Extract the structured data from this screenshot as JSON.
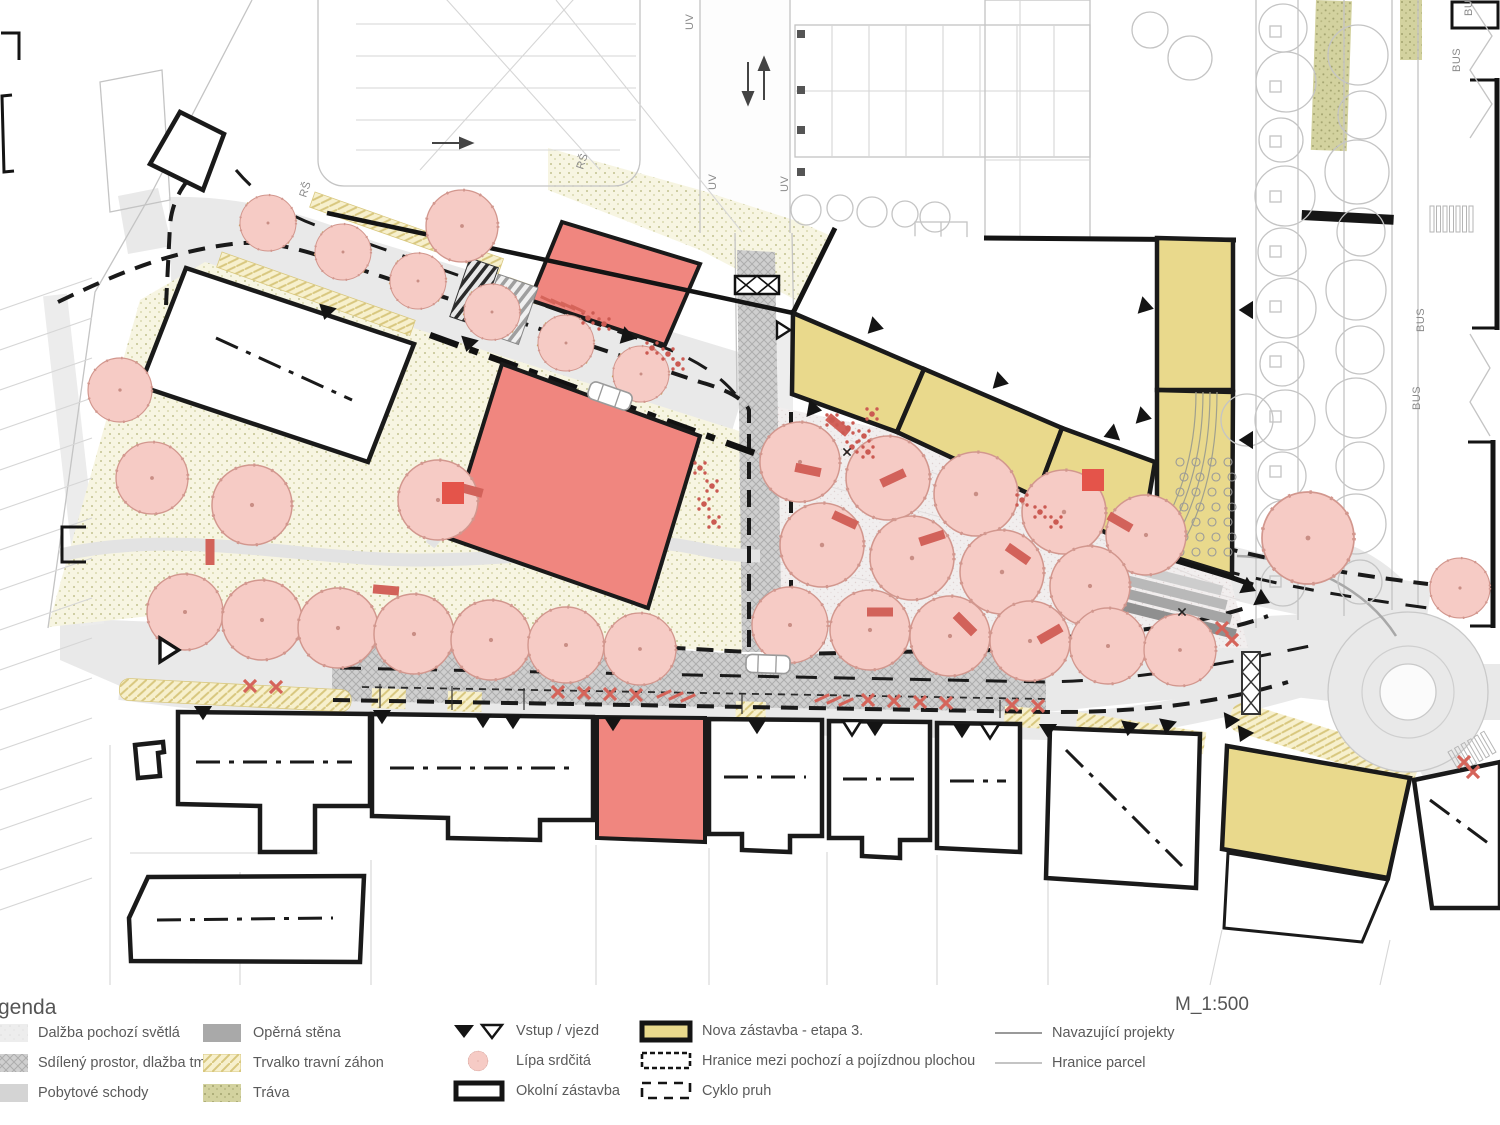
{
  "legend": {
    "title_fragment": "genda",
    "cols": [
      [
        {
          "label": "Dalžba pochozí světlá"
        },
        {
          "label": "Sdílený prostor, dlažba tmavá"
        },
        {
          "label": "Pobytové schody"
        }
      ],
      [
        {
          "label": "Opěrná stěna"
        },
        {
          "label": "Trvalko travní záhon"
        },
        {
          "label": "Tráva"
        }
      ],
      [
        {
          "label": "Vstup / vjezd"
        },
        {
          "label": "Lípa srdčitá"
        },
        {
          "label": "Okolní zástavba"
        }
      ],
      [
        {
          "label": "Nova zástavba - etapa 3."
        },
        {
          "label": "Hranice mezi pochozí a pojízdnou plochou"
        },
        {
          "label": "Cyklo pruh"
        }
      ],
      [
        {
          "label": "Navazující projekty"
        },
        {
          "label": "Hranice parcel"
        }
      ]
    ]
  },
  "scale": "M_1:500",
  "map_labels": {
    "bus": "BUS",
    "uv": "UV",
    "rs": "RŠ"
  },
  "colors": {
    "tree_fill": "#f6cbc5",
    "tree_stroke": "#d2978e",
    "building_red": "#f0867f",
    "building_yellow": "#e9d98c",
    "bench_red": "#d2625a",
    "table_red": "#cb5a52",
    "outline": "#1a1a1a",
    "context": "#c4c4c4",
    "paving_dark": "#cfcfcf",
    "paving_light": "#ececec",
    "park_bg": "#f7f5e2",
    "grass": "#d3d29f",
    "hatch_yellow": "#f7f0cd",
    "text_gray": "#5a5a5a"
  },
  "plan": {
    "trees": [
      [
        152,
        478,
        36
      ],
      [
        252,
        505,
        40
      ],
      [
        438,
        500,
        40
      ],
      [
        120,
        390,
        32
      ],
      [
        185,
        612,
        38
      ],
      [
        262,
        620,
        40
      ],
      [
        338,
        628,
        40
      ],
      [
        414,
        634,
        40
      ],
      [
        491,
        640,
        40
      ],
      [
        566,
        645,
        38
      ],
      [
        640,
        649,
        36
      ],
      [
        800,
        462,
        40
      ],
      [
        888,
        478,
        42
      ],
      [
        976,
        494,
        42
      ],
      [
        1064,
        512,
        42
      ],
      [
        1146,
        535,
        40
      ],
      [
        822,
        545,
        42
      ],
      [
        912,
        558,
        42
      ],
      [
        1002,
        572,
        42
      ],
      [
        1090,
        586,
        40
      ],
      [
        790,
        625,
        38
      ],
      [
        870,
        630,
        40
      ],
      [
        950,
        636,
        40
      ],
      [
        1030,
        641,
        40
      ],
      [
        1108,
        646,
        38
      ],
      [
        1180,
        650,
        36
      ],
      [
        462,
        226,
        36
      ],
      [
        1308,
        538,
        46
      ],
      [
        1460,
        588,
        30
      ],
      [
        268,
        223,
        28
      ],
      [
        343,
        252,
        28
      ],
      [
        418,
        281,
        28
      ],
      [
        492,
        312,
        28
      ],
      [
        566,
        343,
        28
      ],
      [
        641,
        374,
        28
      ]
    ],
    "planters": [
      [
        268,
        223
      ],
      [
        343,
        252
      ],
      [
        418,
        281
      ],
      [
        492,
        312
      ],
      [
        566,
        343
      ],
      [
        641,
        374
      ]
    ],
    "context_trees": [
      [
        1283,
        28,
        24
      ],
      [
        1286,
        82,
        30
      ],
      [
        1281,
        140,
        22
      ],
      [
        1285,
        196,
        30
      ],
      [
        1282,
        252,
        24
      ],
      [
        1286,
        308,
        30
      ],
      [
        1282,
        364,
        22
      ],
      [
        1285,
        420,
        30
      ],
      [
        1282,
        476,
        24
      ],
      [
        1286,
        530,
        30
      ],
      [
        1283,
        584,
        22
      ],
      [
        1358,
        55,
        30
      ],
      [
        1362,
        115,
        24
      ],
      [
        1357,
        172,
        32
      ],
      [
        1361,
        232,
        24
      ],
      [
        1356,
        290,
        30
      ],
      [
        1360,
        350,
        24
      ],
      [
        1356,
        408,
        30
      ],
      [
        1360,
        466,
        24
      ],
      [
        1356,
        524,
        30
      ],
      [
        1360,
        582,
        22
      ],
      [
        1247,
        420,
        26
      ],
      [
        1150,
        30,
        18
      ],
      [
        1190,
        58,
        22
      ],
      [
        806,
        210,
        15
      ],
      [
        840,
        208,
        13
      ],
      [
        872,
        212,
        15
      ],
      [
        905,
        214,
        13
      ],
      [
        935,
        217,
        15
      ]
    ],
    "context_squares": {
      "x": 1270,
      "y0": 26,
      "n": 11,
      "dy": 55,
      "s": 11
    },
    "benches": [
      [
        210,
        552,
        90
      ],
      [
        386,
        590,
        5
      ],
      [
        470,
        490,
        15
      ],
      [
        845,
        520,
        25
      ],
      [
        932,
        538,
        -18
      ],
      [
        1018,
        554,
        35
      ],
      [
        880,
        612,
        0
      ],
      [
        965,
        624,
        45
      ],
      [
        1050,
        634,
        -30
      ],
      [
        808,
        470,
        12
      ],
      [
        893,
        478,
        -25
      ],
      [
        838,
        425,
        40
      ],
      [
        1120,
        522,
        30
      ]
    ],
    "red_squares": [
      [
        453,
        493
      ],
      [
        1093,
        480
      ]
    ],
    "tables": [
      [
        588,
        318
      ],
      [
        604,
        324
      ],
      [
        652,
        348
      ],
      [
        668,
        354
      ],
      [
        678,
        364
      ],
      [
        700,
        468
      ],
      [
        712,
        486
      ],
      [
        704,
        504
      ],
      [
        714,
        522
      ],
      [
        832,
        420
      ],
      [
        848,
        428
      ],
      [
        864,
        436
      ],
      [
        872,
        414
      ],
      [
        1022,
        500
      ],
      [
        1040,
        512
      ],
      [
        1056,
        522
      ],
      [
        852,
        447
      ],
      [
        868,
        452
      ]
    ],
    "red_x": [
      [
        558,
        692
      ],
      [
        584,
        693
      ],
      [
        610,
        694
      ],
      [
        636,
        695
      ],
      [
        868,
        700
      ],
      [
        894,
        701
      ],
      [
        920,
        702
      ],
      [
        946,
        703
      ],
      [
        1012,
        705
      ],
      [
        1038,
        706
      ],
      [
        250,
        686
      ],
      [
        276,
        687
      ],
      [
        1222,
        628
      ],
      [
        1232,
        640
      ],
      [
        1464,
        762
      ],
      [
        1473,
        772
      ]
    ],
    "black_x": [
      [
        847,
        452
      ],
      [
        1182,
        612
      ]
    ],
    "red_slash": [
      [
        664,
        694,
        65
      ],
      [
        676,
        696,
        65
      ],
      [
        688,
        698,
        65
      ],
      [
        822,
        698,
        65
      ],
      [
        834,
        700,
        65
      ],
      [
        846,
        702,
        65
      ],
      [
        548,
        300,
        115
      ],
      [
        558,
        303,
        115
      ],
      [
        568,
        306,
        115
      ],
      [
        578,
        309,
        115
      ]
    ],
    "tri_black": [
      [
        203,
        706,
        90
      ],
      [
        382,
        710,
        90
      ],
      [
        483,
        714,
        90
      ],
      [
        513,
        715,
        90
      ],
      [
        613,
        717,
        90
      ],
      [
        757,
        720,
        90
      ],
      [
        875,
        722,
        90
      ],
      [
        962,
        724,
        90
      ],
      [
        1048,
        724,
        90
      ],
      [
        1130,
        722,
        100
      ],
      [
        1168,
        720,
        100
      ],
      [
        1232,
        716,
        115
      ],
      [
        1246,
        729,
        115
      ],
      [
        870,
        325,
        15
      ],
      [
        995,
        380,
        15
      ],
      [
        1140,
        305,
        15
      ],
      [
        1138,
        415,
        15
      ],
      [
        1117,
        432,
        160
      ],
      [
        808,
        408,
        10
      ],
      [
        1243,
        585,
        25
      ],
      [
        1257,
        597,
        25
      ],
      [
        328,
        306,
        105
      ],
      [
        470,
        338,
        105
      ],
      [
        622,
        335,
        15
      ],
      [
        1253,
        310,
        180
      ],
      [
        1253,
        440,
        180
      ]
    ],
    "tri_white": [
      [
        852,
        721,
        90
      ],
      [
        990,
        724,
        90
      ],
      [
        160,
        650,
        0,
        1.7
      ],
      [
        777,
        330,
        0,
        1.2
      ]
    ],
    "chairs": {
      "x0": 1180,
      "y0": 462,
      "cols": 4,
      "rows": 7,
      "dx": 16,
      "dy": 15,
      "r": 4
    },
    "zebras": [
      {
        "x": 1430,
        "y": 206,
        "n": 7,
        "dx": 6.5,
        "w": 4,
        "h": 26,
        "rot": 0
      },
      {
        "x": 1448,
        "y": 752,
        "n": 6,
        "dx": 7.5,
        "w": 4,
        "h": 24,
        "rot": -30
      }
    ],
    "hatch_left": {
      "y0": 310,
      "n": 16,
      "dy": 40,
      "len": 92,
      "drop": 32
    },
    "labels": {
      "bus": [
        [
          1460,
          72
        ],
        [
          1424,
          332
        ],
        [
          1420,
          410
        ],
        [
          1472,
          16
        ]
      ],
      "uv": [
        [
          693,
          30
        ],
        [
          716,
          190
        ],
        [
          788,
          192
        ]
      ],
      "rs": [
        [
          306,
          198
        ],
        [
          583,
          170
        ]
      ]
    }
  }
}
